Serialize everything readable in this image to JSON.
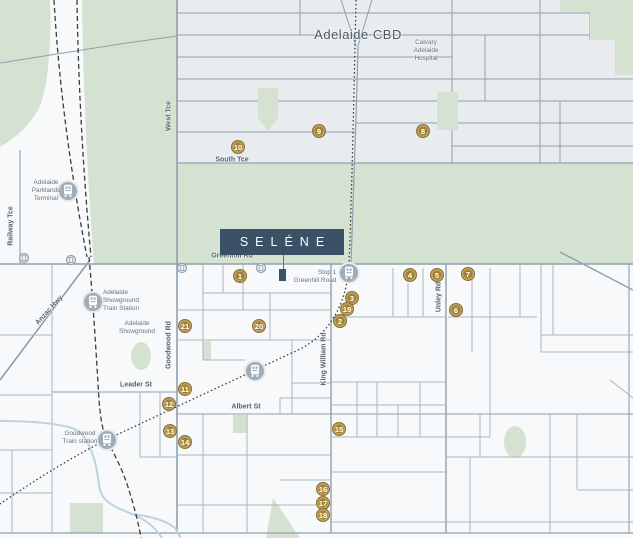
{
  "brand": {
    "name": "SELÉNE"
  },
  "map": {
    "labels": {
      "adelaide_cbd": "Adelaide CBD",
      "calvary_hospital": "Calvary\nAdelaide\nHospital",
      "west_tce": "West Tce",
      "south_tce": "South Tce",
      "railway_tce": "Railway Tce",
      "adelaide_parklands_terminal": "Adelaide\nParklands\nTerminal",
      "anzac_hwy": "Anzac Hwy",
      "greenhill_rd": "Greenhill Rd",
      "stop_1_greenhill_road": "Stop 1\nGreenhill Road",
      "adelaide_showground_train_station": "Adelaide\nShowground\nTrain Station",
      "adelaide_showground": "Adelaide\nShowground",
      "goodwood_rd": "Goodwood Rd",
      "king_william_rd": "King William Rd",
      "unley_rd": "Unley Rd",
      "leader_st": "Leader St",
      "albert_st": "Albert St",
      "goodwood_train_station": "Goodwood\nTrain station"
    },
    "markers": [
      {
        "n": 1,
        "x": 240,
        "y": 276
      },
      {
        "n": 2,
        "x": 340,
        "y": 321
      },
      {
        "n": 3,
        "x": 352,
        "y": 298
      },
      {
        "n": 4,
        "x": 410,
        "y": 275
      },
      {
        "n": 5,
        "x": 437,
        "y": 275
      },
      {
        "n": 6,
        "x": 456,
        "y": 310
      },
      {
        "n": 7,
        "x": 468,
        "y": 274
      },
      {
        "n": 8,
        "x": 423,
        "y": 131
      },
      {
        "n": 9,
        "x": 319,
        "y": 131
      },
      {
        "n": 10,
        "x": 238,
        "y": 147
      },
      {
        "n": 11,
        "x": 185,
        "y": 389
      },
      {
        "n": 12,
        "x": 169,
        "y": 404
      },
      {
        "n": 13,
        "x": 170,
        "y": 431
      },
      {
        "n": 14,
        "x": 185,
        "y": 442
      },
      {
        "n": 15,
        "x": 339,
        "y": 429
      },
      {
        "n": 16,
        "x": 323,
        "y": 489
      },
      {
        "n": 17,
        "x": 323,
        "y": 503
      },
      {
        "n": 18,
        "x": 323,
        "y": 515
      },
      {
        "n": 19,
        "x": 347,
        "y": 309
      },
      {
        "n": 20,
        "x": 259,
        "y": 326
      },
      {
        "n": 21,
        "x": 185,
        "y": 326
      }
    ],
    "colors": {
      "marker_gold": "#a28132",
      "brand_navy": "#3b5165",
      "parkland_green": "#d6e2d1",
      "cbd_block": "#e9ecee",
      "road_line": "#8ea0ae",
      "rail_black": "#383d42",
      "creek_blue": "#bdd3de",
      "station_grey": "#9fadb9"
    }
  }
}
